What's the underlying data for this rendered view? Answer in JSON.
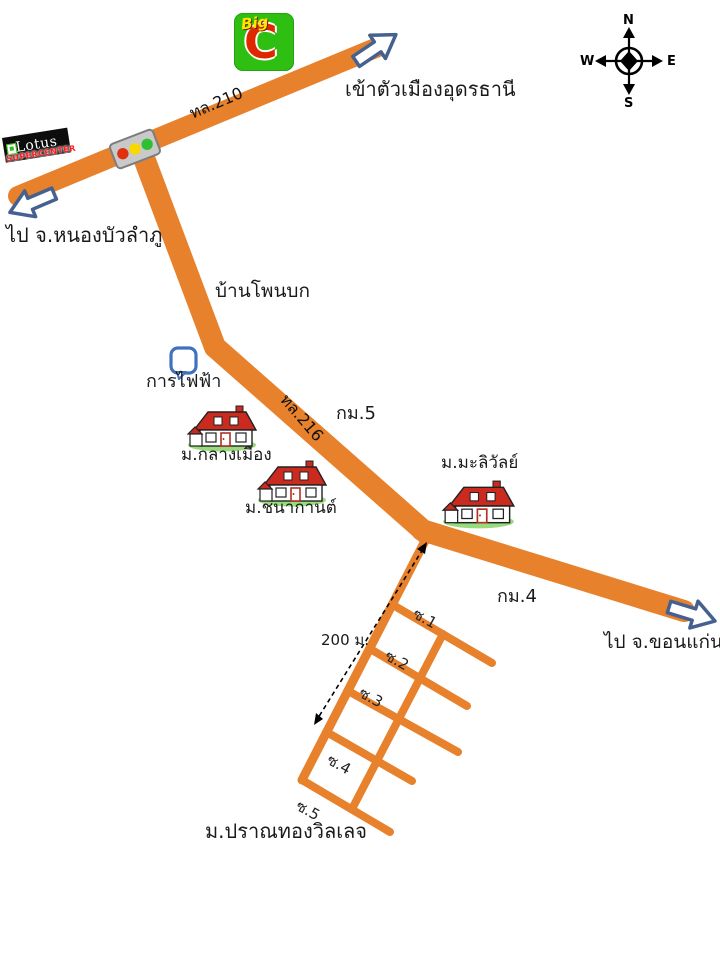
{
  "title": "แผนที่ ม.ปราณทองวิลเลจ",
  "labels": {
    "udon": "เข้าตัวเมืองอุดรธานี",
    "nongbua": "ไป จ.หนองบัวลำภู",
    "khonkaen": "ไป จ.ขอนแก่น",
    "route210": "ทล.210",
    "route216": "ทล.216",
    "km5": "กม.5",
    "km4": "กม.4",
    "banphonbok": "บ้านโพนบก",
    "electricity": "การไฟฟ้า",
    "klangmueang": "ม.กลางเมือง",
    "chanakan": "ม.ชนากานต์",
    "maliwan": "ม.มะลิวัลย์",
    "pranthong": "ม.ปราณทองวิลเลจ",
    "distance": "200 ม."
  },
  "sois": [
    "ซ.1",
    "ซ.2",
    "ซ.3",
    "ซ.4",
    "ซ.5"
  ],
  "compass": {
    "n": "N",
    "e": "E",
    "s": "S",
    "w": "W"
  },
  "logos": {
    "bigc_word": "Big",
    "bigc_letter": "C",
    "lotus_word": "Lotus",
    "lotus_sub": "SUPERCENTER"
  },
  "icons": {
    "traffic-light-icon": "red / yellow / green signal on road junction",
    "house-icon": "red-roof house with green lawn",
    "electricity-icon": "blue rounded square marker",
    "compass-rose-icon": "N E S W cross compass",
    "direction-arrow-icon": "white block arrow with dark blue outline",
    "distance-arrow-icon": "black dashed double-headed arrow"
  },
  "colors": {
    "road_orange": "#E8812C",
    "arrow_fill": "#FFFFFF",
    "arrow_stroke": "#46618F",
    "bigc_green": "#2FBF12",
    "bigc_yellow": "#FFE600",
    "bigc_red": "#E02800",
    "lotus_black": "#0D0D0D",
    "lotus_red": "#FF1A1A",
    "traffic_red": "#E03010",
    "traffic_yellow": "#F8D800",
    "traffic_green": "#2FC02F",
    "house_roof_red": "#CB2A1E",
    "grass_green": "#98DB7C",
    "electricity_blue": "#4070C0",
    "text_black": "#1A1A1A"
  }
}
